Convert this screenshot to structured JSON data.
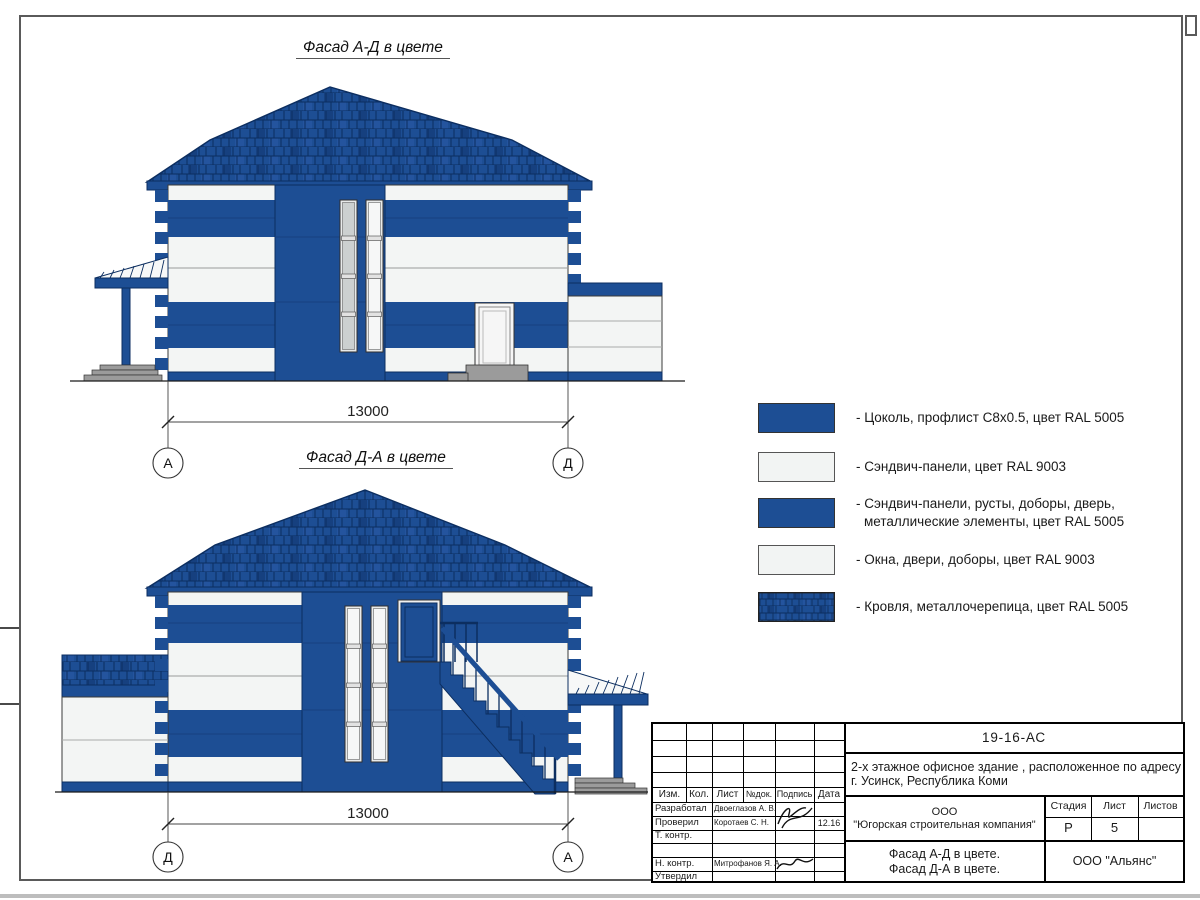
{
  "sheet": {
    "kind": "facade color elevations drawing"
  },
  "facade1": {
    "title": "Фасад А-Д в цвете",
    "dimension": "13000",
    "axis_left": "А",
    "axis_right": "Д"
  },
  "facade2": {
    "title": "Фасад Д-А в цвете",
    "dimension": "13000",
    "axis_left": "Д",
    "axis_right": "А"
  },
  "legend": {
    "items": [
      {
        "swatch": "solid-blue",
        "label": "- Цоколь, профлист С8х0.5, цвет RAL 5005",
        "label2": ""
      },
      {
        "swatch": "solid-white",
        "label": "- Сэндвич-панели, цвет RAL 9003",
        "label2": ""
      },
      {
        "swatch": "solid-blue",
        "label": "- Сэндвич-панели, русты, доборы, дверь,",
        "label2": "металлические элементы, цвет RAL 5005"
      },
      {
        "swatch": "solid-white",
        "label": "- Окна, двери, доборы, цвет RAL 9003",
        "label2": ""
      },
      {
        "swatch": "roof-pattern",
        "label": "- Кровля, металлочерепица, цвет RAL 5005",
        "label2": ""
      }
    ]
  },
  "title_block": {
    "doc_number": "19-16-АС",
    "object_line1": "2-х этажное офисное здание , расположенное по адресу",
    "object_line2": "г. Усинск, Республика Коми",
    "header": {
      "izm": "Изм.",
      "kol": "Кол.",
      "list": "Лист",
      "ndok": "№док.",
      "podpis": "Подпись",
      "data": "Дата"
    },
    "rows": [
      {
        "role": "Разработал",
        "name": "Двоеглазов А. В.",
        "date": ""
      },
      {
        "role": "Проверил",
        "name": "Коротаев С. Н.",
        "date": "12.16"
      },
      {
        "role": "Т. контр.",
        "name": "",
        "date": ""
      },
      {
        "role": "",
        "name": "",
        "date": ""
      },
      {
        "role": "Н. контр.",
        "name": "Митрофанов Я. А.",
        "date": ""
      },
      {
        "role": "Утвердил",
        "name": "",
        "date": ""
      }
    ],
    "company_line1": "ООО",
    "company_line2": "\"Югорская строительная компания\"",
    "stage_label": "Стадия",
    "sheet_label": "Лист",
    "sheets_label": "Листов",
    "stage_value": "Р",
    "sheet_value": "5",
    "sheets_value": "",
    "drawing_line1": "Фасад А-Д в цвете.",
    "drawing_line2": "Фасад Д-А в цвете.",
    "contractor": "ООО \"Альянс\""
  },
  "colors": {
    "ral5005_blue": "#1d4e94",
    "ral9003_white": "#f2f4f3",
    "roof_joint": "#0c2e60",
    "steps_gray": "#9b9b9b"
  }
}
